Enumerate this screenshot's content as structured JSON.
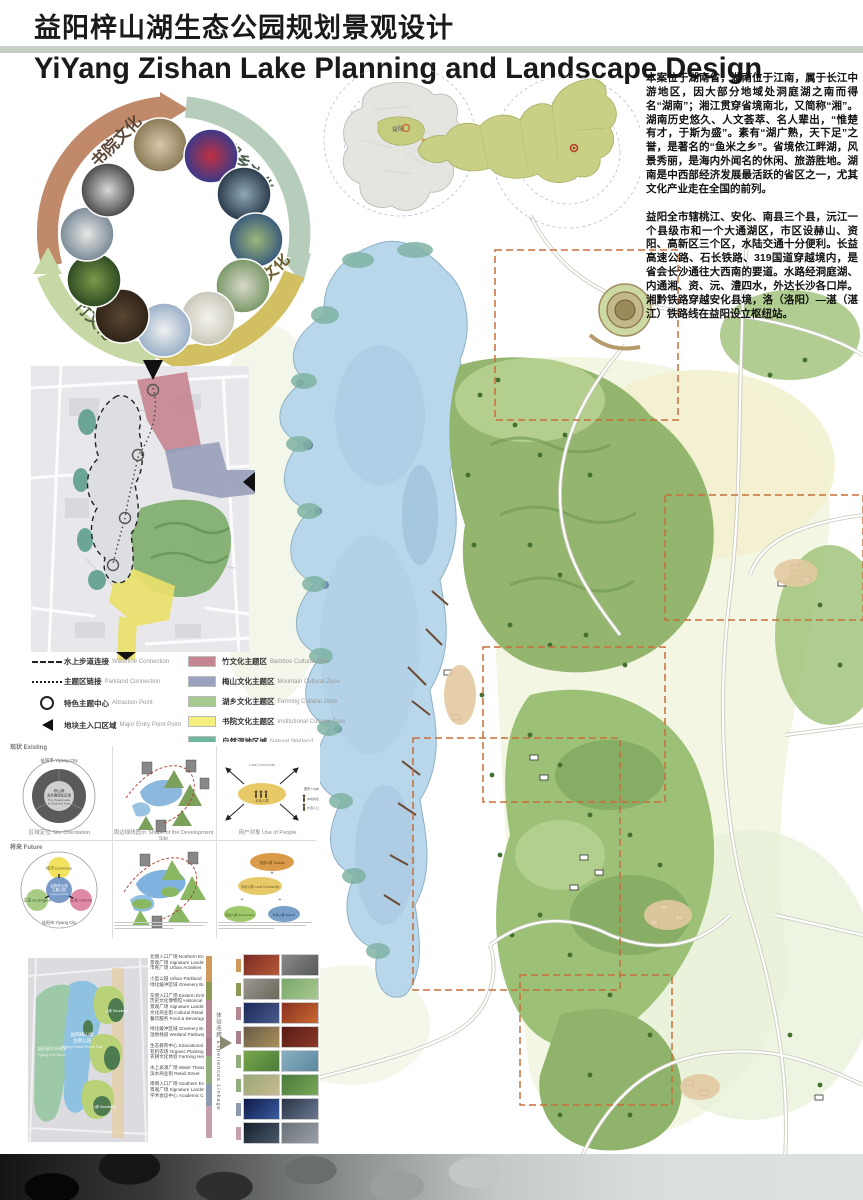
{
  "palette": {
    "divider": "#c6cfc6",
    "arc_academy": "#c08a6a",
    "arc_lake": "#b7cdbb",
    "arc_meishan": "#d2bf62",
    "arc_bamboo": "#c6d8a4",
    "zone_bamboo": "#c5848f",
    "zone_mountain": "#9aa3bd",
    "zone_farming": "#a5cc8e",
    "zone_institutional": "#f4ef7d",
    "zone_wetland": "#6fb79c",
    "lake_blue": "#b9d7ea",
    "dashed_boundary_orange": "#c96f3a"
  },
  "header": {
    "title_cn": "益阳梓山湖生态公园规划景观设计",
    "title_en": "YiYang Zishan Lake Planning and Landscape Design"
  },
  "culture_ring": {
    "arcs": [
      {
        "label": "书院文化"
      },
      {
        "label": "湖乡文化"
      },
      {
        "label": "梅山文化"
      },
      {
        "label": "竹文化"
      }
    ]
  },
  "location": {
    "marker_city": "益阳",
    "capital": "长沙"
  },
  "intro": {
    "para1": "本案位于湖南省，湖南位于江南，属于长江中游地区，因大部分地域处洞庭湖之南而得名“湖南”；湘江贯穿省境南北，又简称“湘”。湖南历史悠久、人文荟萃、名人辈出，“惟楚有才，于斯为盛”。素有“湖广熟，天下足”之誉，是著名的“鱼米之乡”。省境依江畔湖，风景秀丽，是海内外闻名的休闲、旅游胜地。湖南是中西部经济发展最活跃的省区之一，尤其文化产业走在全国的前列。",
    "para2": "益阳全市辖桃江、安化、南县三个县，沅江一个县级市和一个大通湖区，市区设赫山、资阳、高新区三个区，水陆交通十分便利。长益高速公路、石长铁路、319国道穿越境内，是省会长沙通往大西南的要道。水路经洞庭湖、内通湘、资、沅、澧四水，外达长沙各口岸。湘黔铁路穿越安化县境，洛（洛阳）—湛（湛江）铁路线在益阳设立枢纽站。"
  },
  "zoning_legend": {
    "markers": [
      {
        "label_cn": "水上步道连接",
        "label_en": "Waterline Connection"
      },
      {
        "label_cn": "主题区链接",
        "label_en": "Parkland Connection"
      },
      {
        "label_cn": "特色主题中心",
        "label_en": "Attraction Point"
      },
      {
        "label_cn": "地块主入口区域",
        "label_en": "Major Entry Point Point"
      }
    ],
    "zones": [
      {
        "label_cn": "竹文化主题区",
        "label_en": "Bamboo Cultural Zone",
        "color": "#c5848f"
      },
      {
        "label_cn": "梅山文化主题区",
        "label_en": "Mountain Cultural Zone",
        "color": "#9aa3bd"
      },
      {
        "label_cn": "湖乡文化主题区",
        "label_en": "Farming Cultural Zone",
        "color": "#a5cc8e"
      },
      {
        "label_cn": "书院文化主题区",
        "label_en": "Institutional Cultural Zone",
        "color": "#f4ef7d"
      },
      {
        "label_cn": "自然湿地区域",
        "label_en": "Natural Wetland",
        "color": "#6fb79c"
      }
    ]
  },
  "analysis": {
    "row1_label": "现状 Existing",
    "row2_label": "将来 Future",
    "captions": [
      "区域定位 Site Orientation",
      "周边绿线图示 Shape of the Development Site",
      "用户对象 Use of People"
    ],
    "site_orientation": {
      "outer": "益阳市 Yiyang City",
      "center_line1": "梓山湖",
      "center_line2": "及外围绿化区域",
      "center_line3": "The Yiyang Lake",
      "center_line4": "& Greenery Area"
    },
    "use_people": {
      "center_line1": "本地人群",
      "center_line2": "Local Community",
      "legend_title": "图例 Legend",
      "legend_item1": "本地常住 Local",
      "legend_item2": "外围人口 Outside"
    },
    "future_venn": {
      "outer": "益阳市 Yiyang City",
      "economy": "经济 Economy",
      "ecological": "生态 Ecological",
      "culture": "文化 Culture",
      "center_line1": "益阳梓山湖",
      "center_line2": "主题公园",
      "center_line3": "Yiyang Central",
      "center_line4": "Theme Park"
    },
    "future_people": {
      "top": "旅游人群 Tourists",
      "mid": "本地人群 Local Community",
      "left": "周边人群 Surrounding",
      "right": "外来人群 Visitors"
    }
  },
  "bottom_left": {
    "map_labels": {
      "park_line1": "益阳梓山湖",
      "park_line2": "主题公园",
      "park_line3": "Yiyang Central Theme Park",
      "golf_line1": "益阳高尔夫球场",
      "golf_line2": "Yiyang Golf Course",
      "mountain1": "山体 Mountains",
      "mountain2": "山体 Mountains"
    },
    "linkage_label": "体验连廊 Experiences Linkage",
    "groups": [
      {
        "color": "#cf9a5e",
        "items": [
          "北侧入口广场 Northern Entry place",
          "景观广场 Signature Landmark",
          "市民广场 Urban Activities"
        ]
      },
      {
        "color": "#8a9a56",
        "items": [
          "小型公园 Urban Parkland",
          "绿化缓冲区域 Greenery Buffer Zone"
        ]
      },
      {
        "color": "#b48893",
        "items": [
          "东侧入口广场 Eastern Entry Place",
          "历史文化博物馆 Historical Museum",
          "景观广场 Signature Landmark",
          "文化商业街 Cultural Retail Street",
          "餐饮服务 Food & Beverage"
        ]
      },
      {
        "color": "#a87f8a",
        "items": [
          "绿化缓冲区域 Greenery Buffer Zone",
          "湿地栈道 Wetland Pathway"
        ]
      },
      {
        "color": "#93ad7c",
        "items": [
          "生态教育中心 Educational Center",
          "有机农场 Organic Planting",
          "农耕文化体验 Farming Heritage"
        ]
      },
      {
        "color": "#8d9ab0",
        "items": [
          "水上表演广场 Water Theatres",
          "滨水商业街 Retail Street"
        ]
      },
      {
        "color": "#c5a0ad",
        "items": [
          "南侧入口广场 Southern Entry Place",
          "景观广场 Signature Landmark",
          "学术会议中心 Academic Conference Center"
        ]
      }
    ]
  }
}
